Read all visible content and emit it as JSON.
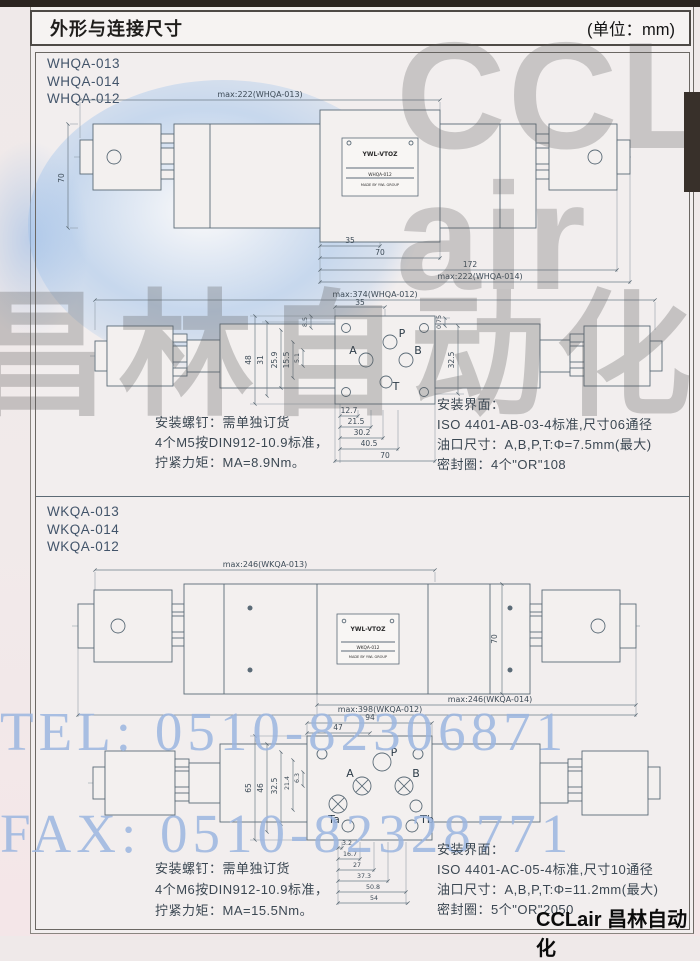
{
  "page": {
    "title": "外形与连接尺寸",
    "unit": "(单位：mm)"
  },
  "watermark": {
    "logo_lines": [
      "CCL",
      "air"
    ],
    "cn": "昌林自动化",
    "tel": "TEL: 0510-82306871",
    "fax": "FAX: 0510-82328771",
    "brand_footer": "CCLair 昌林自动化",
    "accent_blue": "#9cb6e0",
    "grey": "#606060"
  },
  "whqa": {
    "models": [
      "WHQA-013",
      "WHQA-014",
      "WHQA-012"
    ],
    "plate": {
      "brand": "YWL-VTOZ",
      "model": "WHQA-012",
      "made": "MADE BY YWL GROUP"
    },
    "side": {
      "top": "max:222(WHQA-013)",
      "height": "70",
      "d1": "35",
      "d2": "70",
      "d3": "172",
      "bottom": "max:222(WHQA-014)"
    },
    "top": {
      "overall": "max:374(WHQA-012)",
      "d35": "35",
      "left": [
        "48",
        "31",
        "25.9",
        "15.5",
        "5.1",
        "8.5"
      ],
      "right": [
        "0.75",
        "32.5"
      ],
      "bottom": [
        "12.7",
        "21.5",
        "30.2",
        "40.5",
        "70"
      ],
      "ports": {
        "p": "P",
        "a": "A",
        "b": "B",
        "t": "T"
      }
    },
    "screw_notes": [
      "安装螺钉：需单独订货",
      "4个M5按DIN912-10.9标准，",
      "拧紧力矩：MA=8.9Nm。"
    ],
    "iface_notes": [
      "安装界面：",
      "ISO 4401-AB-03-4标准,尺寸06通径",
      "油口尺寸：A,B,P,T:Φ=7.5mm(最大)",
      "密封圈：4个\"OR\"108"
    ]
  },
  "wkqa": {
    "models": [
      "WKQA-013",
      "WKQA-014",
      "WKQA-012"
    ],
    "plate": {
      "brand": "YWL-VTOZ",
      "model": "WKQA-012",
      "made": "MADE BY YWL GROUP"
    },
    "side": {
      "top": "max:246(WKQA-013)",
      "height": "70",
      "bottom1": "max:246(WKQA-014)",
      "bottom2": "max:398(WKQA-012)"
    },
    "top": {
      "d94": "94",
      "d47": "47",
      "left": [
        "65",
        "46",
        "32.5",
        "21.4",
        "6.3"
      ],
      "bottom": [
        "3.2",
        "16.7",
        "27",
        "37.3",
        "50.8",
        "54"
      ],
      "ports": {
        "p": "P",
        "a": "A",
        "b": "B",
        "ta": "Ta",
        "tb": "Tb"
      }
    },
    "screw_notes": [
      "安装螺钉：需单独订货",
      "4个M6按DIN912-10.9标准，",
      "拧紧力矩：MA=15.5Nm。"
    ],
    "iface_notes": [
      "安装界面：",
      "ISO 4401-AC-05-4标准,尺寸10通径",
      "油口尺寸：A,B,P,T:Φ=11.2mm(最大)",
      "密封圈：5个\"OR\"2050"
    ]
  }
}
